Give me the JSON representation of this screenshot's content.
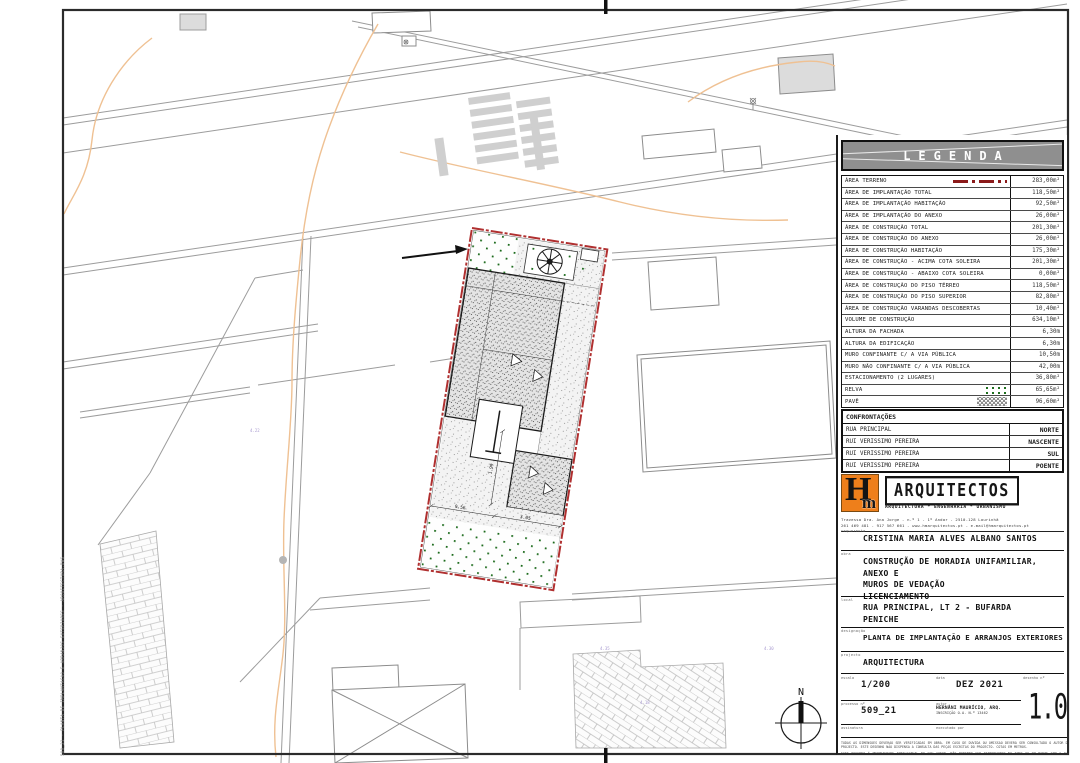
{
  "sheet": {
    "stamp": "509_21 - PLANTA DE IMPLANTACAO E ARRANJOS EXTERIORES - ARQUITECTURA.DWG"
  },
  "legend": {
    "title": "LEGENDA",
    "rows": [
      {
        "label": "ÁREA TERRENO",
        "value": "283,00m²"
      },
      {
        "label": "ÁREA DE IMPLANTAÇÃO TOTAL",
        "value": "118,50m²"
      },
      {
        "label": "ÁREA DE IMPLANTAÇÃO HABITAÇÃO",
        "value": "92,50m²"
      },
      {
        "label": "ÁREA DE IMPLANTAÇÃO DO ANEXO",
        "value": "26,00m²"
      },
      {
        "label": "ÁREA DE CONSTRUÇÃO TOTAL",
        "value": "201,30m²"
      },
      {
        "label": "ÁREA DE CONSTRUÇÃO DO ANEXO",
        "value": "26,00m²"
      },
      {
        "label": "ÁREA DE CONSTRUÇÃO HABITAÇÃO",
        "value": "175,30m²"
      },
      {
        "label": "ÁREA DE CONSTRUÇÃO - ACIMA COTA SOLEIRA",
        "value": "201,30m²"
      },
      {
        "label": "ÁREA DE CONSTRUÇÃO - ABAIXO COTA SOLEIRA",
        "value": "0,00m²"
      },
      {
        "label": "ÁREA DE CONSTRUÇÃO DO PISO TÉRREO",
        "value": "118,50m²"
      },
      {
        "label": "ÁREA DE CONSTRUÇÃO DO PISO SUPERIOR",
        "value": "82,80m²"
      },
      {
        "label": "ÁREA DE CONSTRUÇÃO VARANDAS DESCOBERTAS",
        "value": "10,40m²"
      },
      {
        "label": "VOLUME DE CONSTRUÇÃO",
        "value": "634,10m³"
      },
      {
        "label": "ALTURA DA FACHADA",
        "value": "6,30m"
      },
      {
        "label": "ALTURA DA EDIFICAÇÃO",
        "value": "6,30m"
      },
      {
        "label": "MURO CONFINANTE C/ A VIA PÚBLICA",
        "value": "10,50m"
      },
      {
        "label": "MURO NÃO CONFINANTE C/ A VIA PÚBLICA",
        "value": "42,00m"
      },
      {
        "label": "ESTACIONAMENTO (2 LUGARES)",
        "value": "36,80m²"
      },
      {
        "label": "RELVA",
        "value": "65,65m²"
      },
      {
        "label": "PAVÊ",
        "value": "96,60m²"
      }
    ]
  },
  "confrontacoes": {
    "title": "CONFRONTAÇÕES",
    "rows": [
      {
        "label": "RUA PRINCIPAL",
        "value": "NORTE"
      },
      {
        "label": "RUI VERISSIMO PEREIRA",
        "value": "NASCENTE"
      },
      {
        "label": "RUI VERISSIMO PEREIRA",
        "value": "SUL"
      },
      {
        "label": "RUI VERISSIMO PEREIRA",
        "value": "POENTE"
      }
    ]
  },
  "firm": {
    "initial_h": "H",
    "initial_m": "m",
    "name": "ARQUITECTOS",
    "tagline": "ARQUITECTURA * ENGENHARIA * URBANISMO",
    "address1": "Travessa Dra. Ana Jorge - n.º 1 - 1º Andar - 2510-128 Lourinhã",
    "address2": "261 469 481 - 917 567 661 - www.hmarquitectos.pt - e.mail@hmarquitectos.pt"
  },
  "titleblock": {
    "requerente_label": "requerente",
    "requerente": "CRISTINA MARIA ALVES ALBANO SANTOS",
    "obra_label": "obra",
    "obra_line1": "CONSTRUÇÃO DE MORADIA UNIFAMILIAR, ANEXO E",
    "obra_line2": "MUROS DE VEDAÇÃO",
    "obra_line3": "LICENCIAMENTO",
    "local_label": "local",
    "local_line1": "RUA PRINCIPAL, LT 2 - BUFARDA",
    "local_line2": "PENICHE",
    "designacao_label": "designação",
    "designacao": "PLANTA DE IMPLANTAÇÃO E ARRANJOS EXTERIORES",
    "projecto_label": "projecto",
    "projecto": "ARQUITECTURA",
    "escala_label": "escala",
    "escala": "1/200",
    "data_label": "data",
    "data": "DEZ 2021",
    "desenho_label": "desenho nº",
    "desenho": "1.00",
    "processo_label": "processo nº",
    "processo": "509_21",
    "autor_label": "autor",
    "autor_line1": "HERNÂNI MAURÍCIO, ARQ.",
    "autor_line2": "INSCRIÇÃO O.A. N.º 13462",
    "assinatura_label": "assinatura",
    "executado_label": "executado por",
    "disclaimer1": "TODAS AS DIMENSÕES DEVERÃO SER VERIFICADAS EM OBRA. EM CASO DE DÚVIDA OU OMISSÃO DEVERÁ SER CONSULTADO O AUTOR DO PROJECTO. ESTE DESENHO NÃO DISPENSA A CONSULTA DAS PEÇAS ESCRITAS DO PROJECTO. COTAS EM METROS.",
    "disclaimer2": "ESTE DESENHO É PROPRIEDADE INTELECTUAL DO SEU AUTOR, NÃO PODENDO SER REPRODUZIDO NO TODO OU EM PARTE SEM A SUA AUTORIZAÇÃO EXPRESSA."
  },
  "plan": {
    "north": "N",
    "dims": [
      "9.56",
      "3.05",
      "1.99"
    ],
    "spots": [
      "4.22",
      "4.35",
      "4.18",
      "4.30"
    ]
  }
}
